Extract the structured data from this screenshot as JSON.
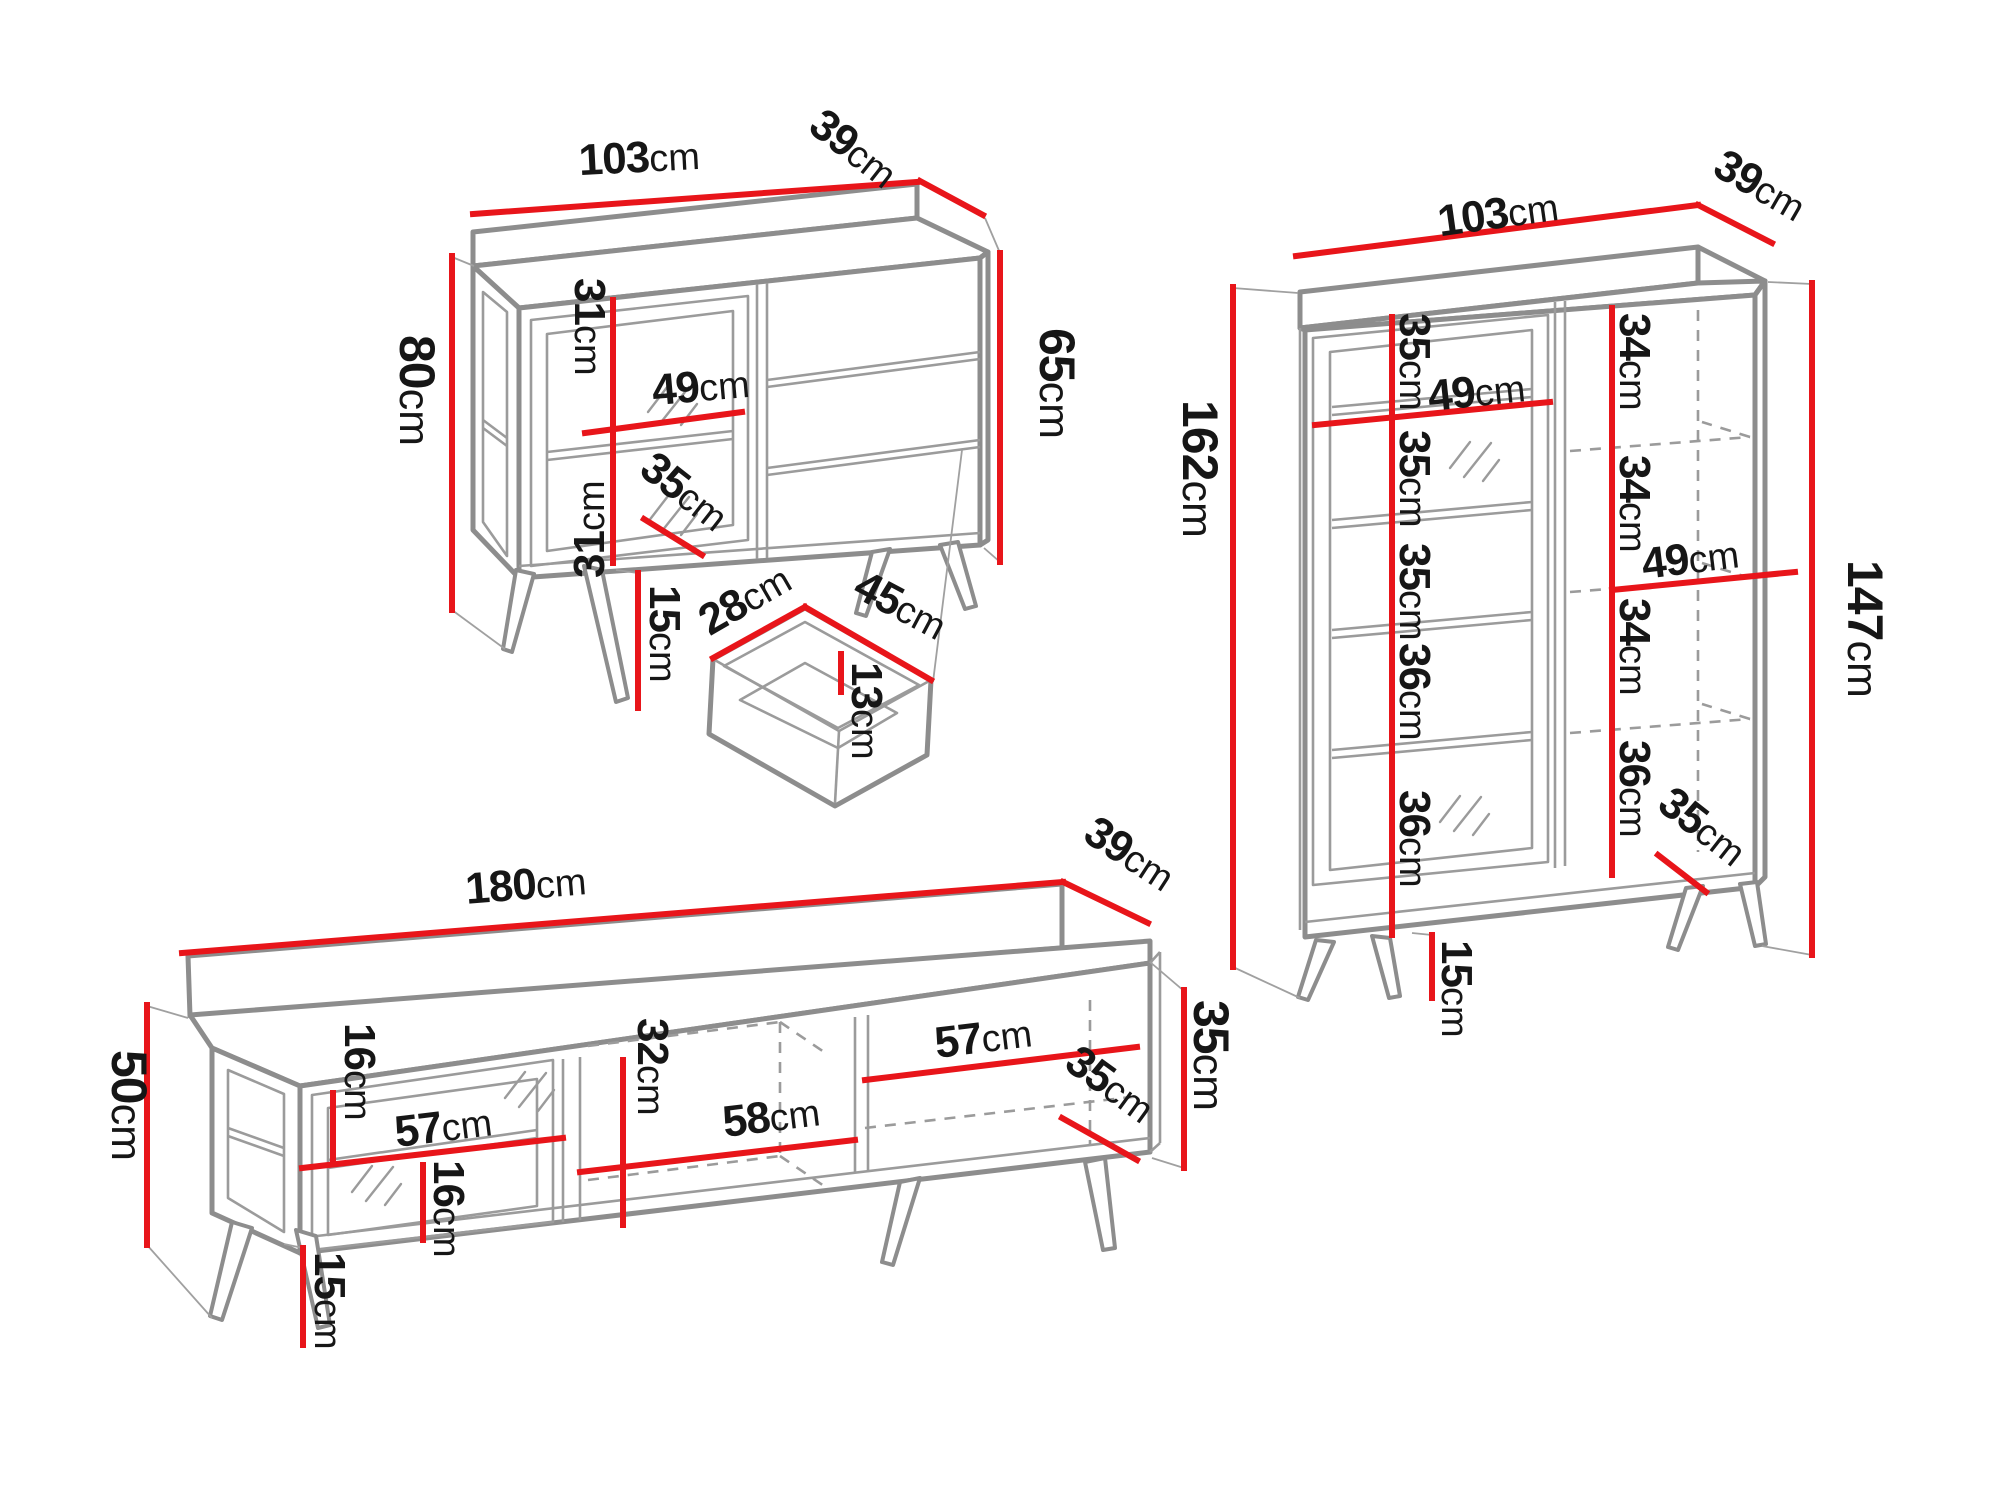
{
  "unit": "cm",
  "colors": {
    "dimension_red": "#e8151a",
    "outline_gray": "#8d8d8d",
    "text": "#161616",
    "background": "#ffffff"
  },
  "sideboard": {
    "width": "103",
    "depth": "39",
    "total_height": "80",
    "body_height": "65",
    "upper_compartment": "31",
    "lower_compartment": "31",
    "shelf_width": "49",
    "interior_depth": "35",
    "leg_height": "15"
  },
  "drawer": {
    "inner_depth": "28",
    "inner_width": "45",
    "inner_height": "13"
  },
  "cabinet": {
    "width": "103",
    "depth": "39",
    "total_height": "162",
    "body_height": "147",
    "left_compartments": [
      "35",
      "35",
      "35",
      "36",
      "36"
    ],
    "right_compartments": [
      "34",
      "34",
      "34",
      "36"
    ],
    "left_shelf_width": "49",
    "right_shelf_width": "49",
    "interior_depth": "35",
    "leg_height": "15"
  },
  "tv_stand": {
    "width": "180",
    "depth": "39",
    "total_height": "50",
    "body_height": "35",
    "upper_compartment": "16",
    "lower_compartment": "16",
    "left_shelf_width": "57",
    "middle_height": "32",
    "middle_shelf_width": "58",
    "right_shelf_width": "57",
    "interior_depth": "35",
    "leg_height": "15"
  }
}
